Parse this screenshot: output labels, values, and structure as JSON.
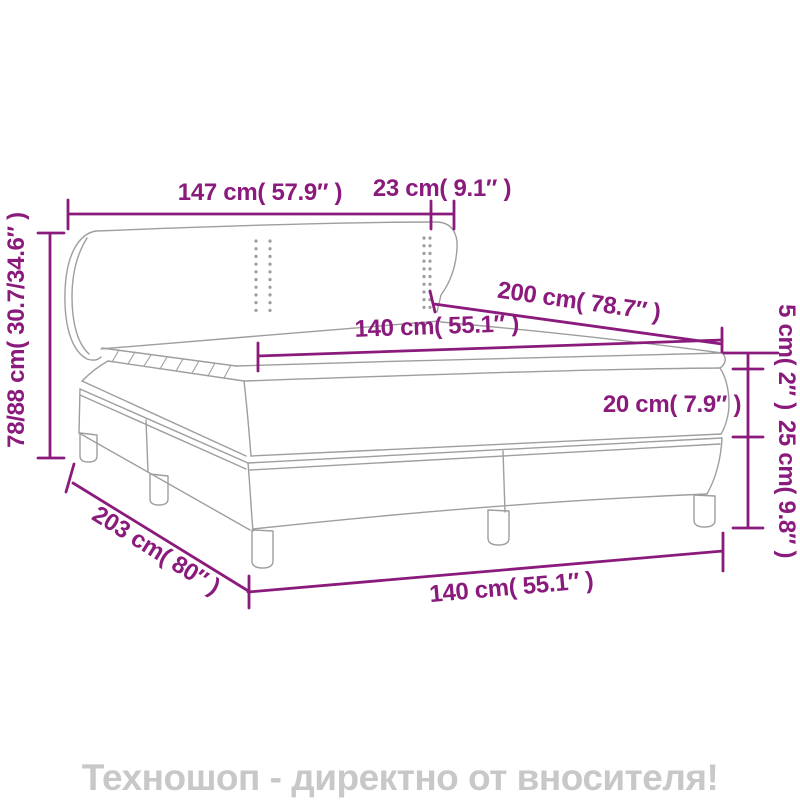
{
  "colors": {
    "dimension": "#8A1A7C",
    "bed_line": "#9E9E9E",
    "footer_text": "#C8C8C8",
    "background": "#FFFFFF"
  },
  "dimensions": {
    "headboard_width": "147 cm( 57.9″ )",
    "headboard_wing_depth": "23 cm( 9.1″ )",
    "overall_height": "78/88 cm( 30.7/34.6″ )",
    "bed_length": "200 cm( 78.7″ )",
    "mattress_width": "140 cm( 55.1″ )",
    "topper_thickness": "5 cm( 2″ )",
    "mattress_thickness": "20 cm( 7.9″ )",
    "base_height": "25 cm( 9.8″ )",
    "frame_length": "203 cm( 80″ )",
    "frame_width": "140 cm( 55.1″ )"
  },
  "footer": {
    "text": "Техношоп - директно от вносителя!"
  }
}
